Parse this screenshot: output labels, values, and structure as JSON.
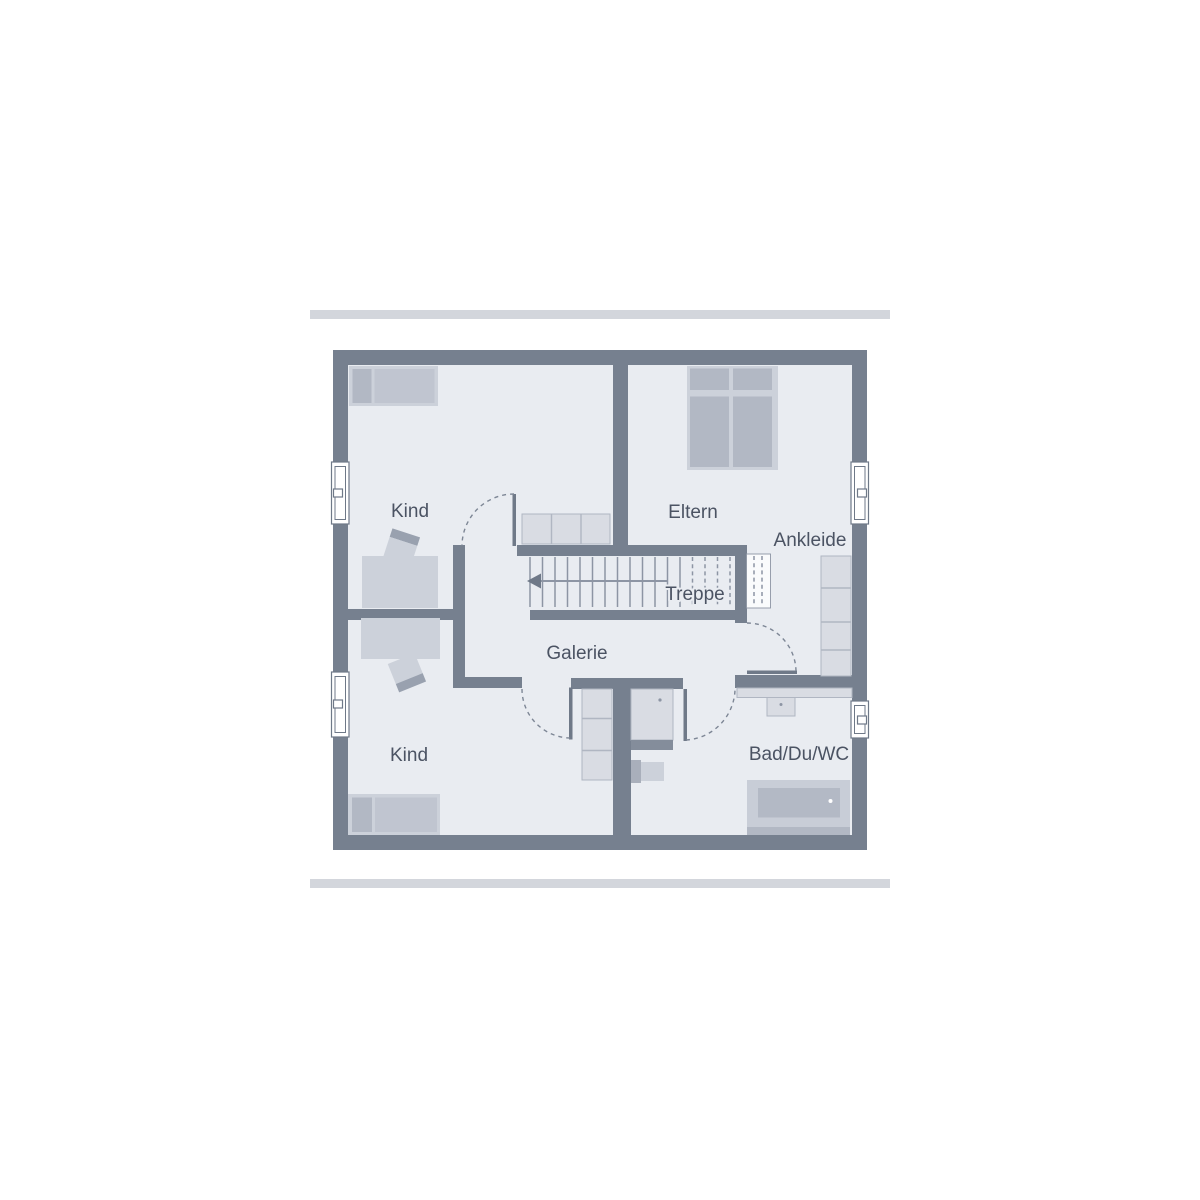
{
  "plan": {
    "rooms": {
      "kind_top": "Kind",
      "eltern": "Eltern",
      "ankleide": "Ankleide",
      "treppe": "Treppe",
      "galerie": "Galerie",
      "kind_bottom": "Kind",
      "bad": "Bad/Du/WC"
    }
  },
  "colors": {
    "background": "#ffffff",
    "divider_bar": "#d3d6dc",
    "wall": "#76808f",
    "floor": "#e9ecf1",
    "furniture_light": "#ccd1da",
    "furniture_mid": "#b2b8c4",
    "furniture_mid2": "#c0c5d0",
    "furniture_dark": "#a9afbb",
    "furniture_pale": "#d9dce3",
    "cabinet_divider": "#b0b6c2",
    "stair_line": "#8d95a4",
    "dash_line": "#7d8695",
    "door_leaf": "#6f7988",
    "window_frame": "#6f7988",
    "chair_back": "#99a1af",
    "shower_strip": "#848d9b",
    "tub_outer": "#c8cdd7",
    "tub_inner": "#b3b9c5",
    "text": "#4b5363"
  }
}
